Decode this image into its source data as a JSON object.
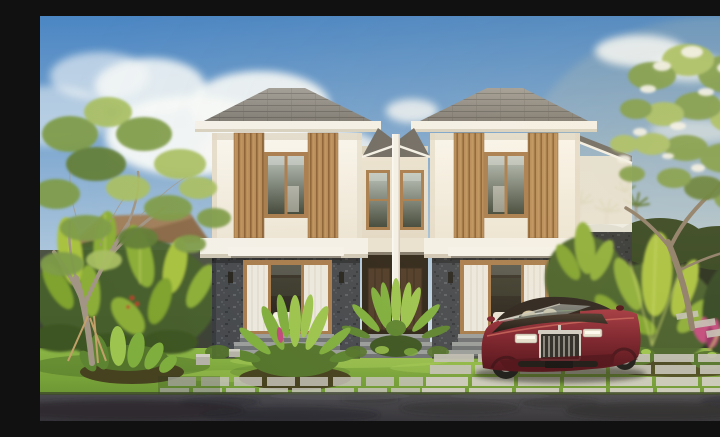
{
  "scene": {
    "description": "Photorealistic render of a symmetrical two-story tropical duplex villa: white upper walls with vertical wood-slat screens and hip roofs, dark grey stone ground floor with wood-framed glass doors, white curtains and awnings, lush garden with frangipani and banana plants, green lawn with concrete paver driveway, a maroon luxury coupe parked in front, and an asphalt road in the foreground under a blue sky with white clouds.",
    "objects": [
      "sky",
      "clouds",
      "frangipani-tree-left",
      "frangipani-tree-right",
      "white-flowers",
      "banana-plants",
      "distant-palm-trees",
      "neighbor-roof",
      "boundary-walls",
      "duplex-villa",
      "hip-roofs",
      "wood-slat-screens",
      "bedroom-windows",
      "stone-facade",
      "awnings",
      "glass-doors",
      "white-curtains",
      "wall-sconces",
      "entry-steps",
      "entry-doors",
      "front-palm",
      "lawn",
      "garden-ferns",
      "pink-cordyline",
      "paver-driveway",
      "stepping-stones",
      "luxury-coupe",
      "asphalt-road"
    ]
  },
  "palette": {
    "sky_top": "#4b86c3",
    "sky_mid": "#a6c2da",
    "sky_horizon": "#e8eef2",
    "cloud": "#f7f9f8",
    "warm_glow": "#ffdf9e",
    "roof_light": "#a19d97",
    "roof_dark": "#7b7771",
    "roof_valley": "#6e6a64",
    "fascia": "#f4f1e9",
    "wall_top": "#faf7f0",
    "wall_bottom": "#ece4d4",
    "wall_shade": "#e0d7c4",
    "slat_base": "#b68a56",
    "slat_groove": "#8a6236",
    "slat_light": "#c69a66",
    "frame_wood": "#a87c4e",
    "glass_top": "#b7c0ba",
    "glass_bottom": "#3f4639",
    "stone_base": "#45484d",
    "stone_light": "#5d6166",
    "stone_dark": "#33363a",
    "awning": "#f6f3ec",
    "curtain": "#ece8df",
    "curtain_fold": "#d6cfc0",
    "interior_top": "#3a352c",
    "interior_bottom": "#241f19",
    "bedding": "#e9e3d7",
    "recess": "#2e2519",
    "door_wood": "#4e3a28",
    "door_wood_dark": "#36281a",
    "step_top": "#9a9d9c",
    "step_face": "#6f7274",
    "lawn_top": "#8cb646",
    "lawn_bottom": "#6d9733",
    "lawn_light": "#a8cc57",
    "lawn_shadow": "#4e7028",
    "soil": "#46411f",
    "moss": "#54742c",
    "fern_dark": "#5d8430",
    "fern_mid": "#7fae3e",
    "fern_light": "#9cc44e",
    "banana_light": "#a9c23f",
    "banana_mid": "#8cae38",
    "banana_dark": "#7fa32e",
    "banana_rib": "#cddc6e",
    "foliage_dark": "#3c5522",
    "foliage_mid": "#7f9c4a",
    "foliage_light": "#a9bf63",
    "foliage_deep": "#647f38",
    "foliage_backdrop": "#46602a",
    "corner_green": "#2e4420",
    "flower_white": "#f3f2ea",
    "flower_pink": "#c2497e",
    "flower_pink_dark": "#8e2f5e",
    "flower_red": "#c0392b",
    "trunk_light": "#a29585",
    "trunk_dark": "#8d7d6a",
    "stick": "#c2a06a",
    "fence_left": "#4c5244",
    "fence_right": "#232b1c",
    "hedge": "#31431f",
    "neighbor_roof": "#8a6a4a",
    "palm_frond": "#5a7330",
    "paver_light": "#cfcdc3",
    "paver_mid": "#c4c2b8",
    "paver_dark": "#b4b2a8",
    "road_top": "#4a494e",
    "road_bottom": "#353439",
    "road_shadow": "#26252a",
    "road_light": "#56555a",
    "car_body_light": "#a23640",
    "car_body": "#7c1f2b",
    "car_body_dark": "#4e0f17",
    "car_highlight": "#c56058",
    "car_top_light": "#44372c",
    "car_top_dark": "#18130f",
    "car_cabin": "#2a221d",
    "chrome": "#cfccc2",
    "chrome_dark": "#8a877e",
    "grille_bg": "#2a2926",
    "grille_slat": "#b9b6ac",
    "headlight": "#e4dfcf",
    "car_glass_top": "#d4dcd8",
    "car_glass_bottom": "#8a9a94",
    "car_interior": "#d6c6a4",
    "tire": "#1b1a18",
    "rim": "#8f8d86",
    "hub": "#d9d7cf",
    "shadow": "#15140f"
  }
}
